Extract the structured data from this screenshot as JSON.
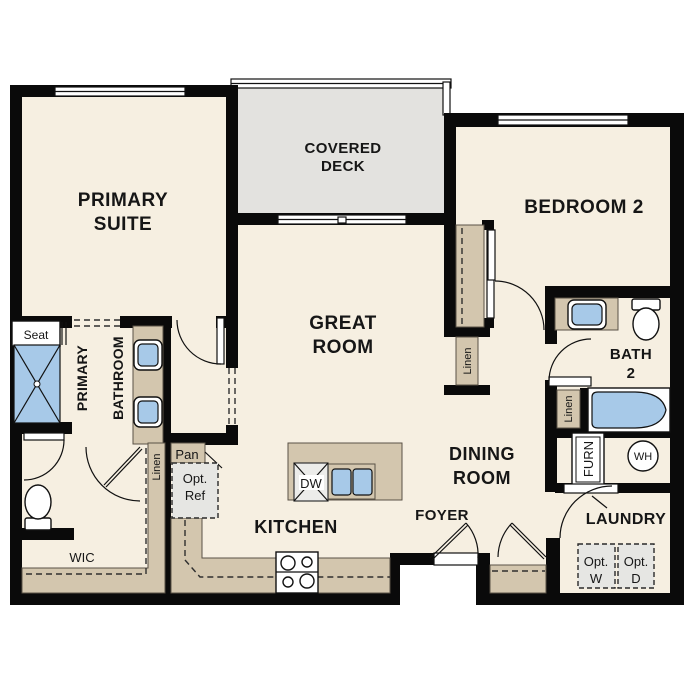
{
  "title": "Floor plan",
  "colors": {
    "wall": "#0a0a0a",
    "floor": "#f6efe1",
    "deck": "#e3e2df",
    "casework": "#d3c6ae",
    "fixture": "#a7c9e8",
    "optbox": "#e6e6e3"
  },
  "labels": {
    "primary_suite": {
      "line1": "PRIMARY",
      "line2": "SUITE"
    },
    "covered_deck": {
      "line1": "COVERED",
      "line2": "DECK"
    },
    "bedroom2": {
      "text": "BEDROOM 2"
    },
    "great_room": {
      "line1": "GREAT",
      "line2": "ROOM"
    },
    "primary_bathroom": {
      "line1": "PRIMARY",
      "line2": "BATHROOM"
    },
    "seat": {
      "text": "Seat"
    },
    "linen_primary": {
      "text": "Linen"
    },
    "pan": {
      "text": "Pan"
    },
    "opt_ref": {
      "line1": "Opt.",
      "line2": "Ref"
    },
    "kitchen": {
      "text": "KITCHEN"
    },
    "dw": {
      "text": "DW"
    },
    "wic": {
      "text": "WIC"
    },
    "dining_room": {
      "line1": "DINING",
      "line2": "ROOM"
    },
    "foyer": {
      "text": "FOYER"
    },
    "linen_hall": {
      "text": "Linen"
    },
    "bath2": {
      "line1": "BATH",
      "line2": "2"
    },
    "linen_bath2": {
      "text": "Linen"
    },
    "furnace": {
      "text": "FURN"
    },
    "water_heater": {
      "text": "WH"
    },
    "laundry": {
      "text": "LAUNDRY"
    },
    "opt_washer": {
      "line1": "Opt.",
      "line2": "W"
    },
    "opt_dryer": {
      "line1": "Opt.",
      "line2": "D"
    }
  }
}
